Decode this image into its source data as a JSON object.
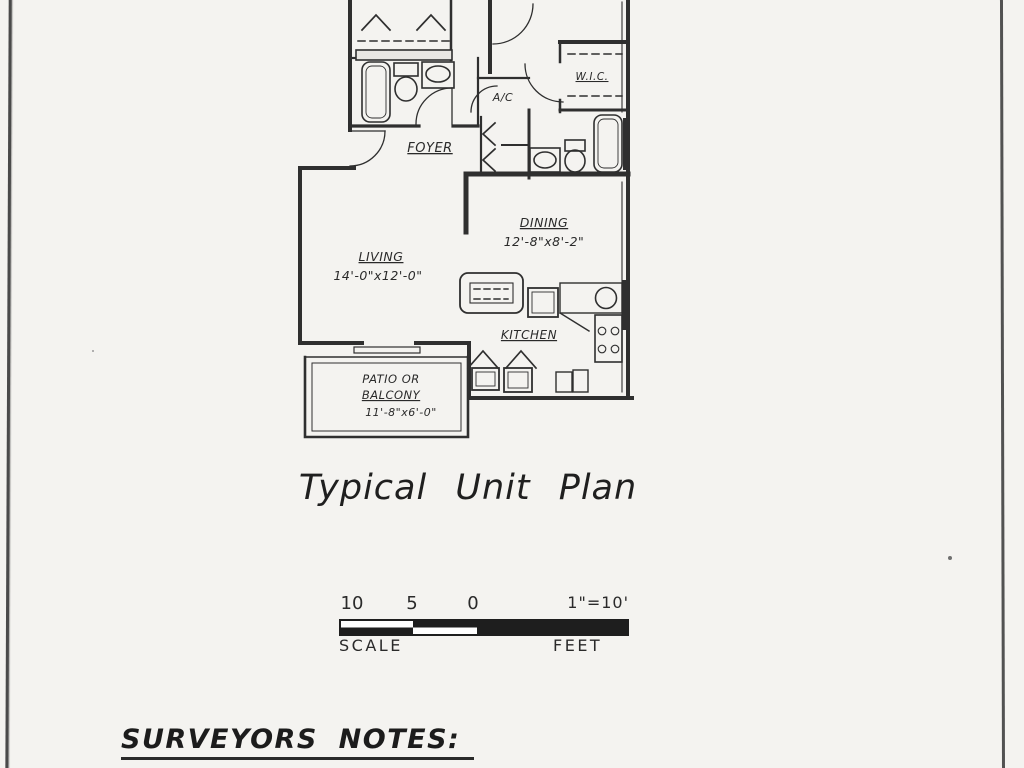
{
  "page": {
    "title_label": "Typical Unit Plan",
    "notes_heading": "SURVEYORS NOTES:"
  },
  "floor_plan": {
    "rooms": {
      "wic": {
        "label": "W.I.C."
      },
      "ac": {
        "label": "A/C"
      },
      "foyer": {
        "label": "FOYER"
      },
      "dining": {
        "label": "DINING",
        "dims": "12'-8\"x8'-2\""
      },
      "living": {
        "label": "LIVING",
        "dims": "14'-0\"x12'-0\""
      },
      "kitchen": {
        "label": "KITCHEN"
      },
      "patio": {
        "line1": "PATIO OR",
        "line2": "BALCONY",
        "dims": "11'-8\"x6'-0\""
      }
    }
  },
  "scale_bar": {
    "ticks": [
      "10",
      "5",
      "0"
    ],
    "ratio": "1\"=10'",
    "left_caption": "SCALE",
    "right_caption": "FEET"
  },
  "colors": {
    "ink": "#2a2a2a",
    "paper": "#f4f3f0"
  }
}
